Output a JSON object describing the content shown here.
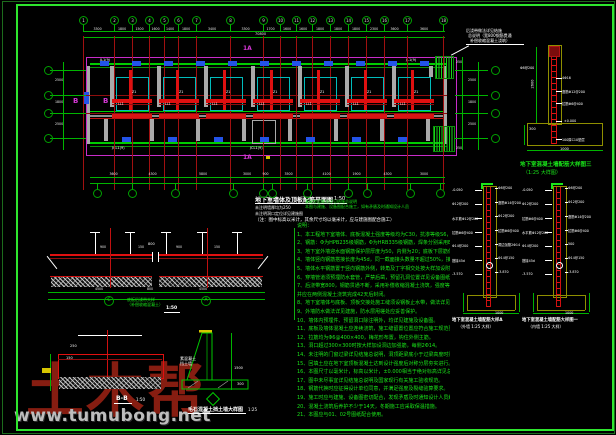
{
  "watermark": {
    "brand": "土木帮",
    "site": "www.tumubong.net"
  },
  "plan": {
    "grid_x": [
      83,
      114,
      132,
      149,
      164,
      178,
      196,
      230,
      263,
      280,
      296,
      312,
      330,
      348,
      366,
      384,
      407,
      443
    ],
    "grid_labels": [
      "1",
      "2",
      "3",
      "4",
      "5",
      "6",
      "7",
      "8",
      "9",
      "10",
      "11",
      "12",
      "13",
      "14",
      "15",
      "16",
      "17",
      "18"
    ],
    "top_dims": [
      "3300",
      "1800",
      "1500",
      "1600",
      "1400",
      "1800",
      "3400",
      "3300",
      "1700",
      "1600",
      "1600",
      "1800",
      "1800",
      "1800",
      "2300",
      "3600",
      "3600"
    ],
    "total_dim": "70800",
    "bottom_grid_x": [
      97,
      132,
      175,
      233,
      263,
      272,
      307,
      348,
      367,
      410,
      440
    ],
    "bottom_dims": [
      "3600",
      "4300",
      "5800",
      "3000",
      "900",
      "3500",
      "4100",
      "1900",
      "4300",
      "3000"
    ],
    "row_y": [
      70,
      95,
      113,
      138
    ],
    "left_dims": [
      "2500",
      "1800",
      "2500"
    ],
    "right_dims_col": [
      "2500",
      "1800",
      "2500"
    ],
    "bay_x": [
      116,
      163,
      210,
      257,
      304,
      351,
      398
    ],
    "bay_tag_beam": "LL1",
    "bay_tag_col": "Z1",
    "clips_top_x": [
      100,
      132,
      164,
      196,
      228,
      260,
      292,
      324,
      356,
      388,
      420
    ],
    "clips_bot_x": [
      122,
      168,
      214,
      260,
      306,
      352,
      398
    ],
    "stubs_low_x": [
      104,
      150,
      196,
      242,
      288,
      334,
      380,
      426
    ],
    "section_marks": {
      "top": "1A",
      "bottom": "1A",
      "b1": "B",
      "b2": "B"
    },
    "beam_labels": {
      "tl": "JL1(9)",
      "tr": "JL1(9)",
      "bl": "JCL1(9)",
      "br": "JCL1(9)"
    },
    "right_end_dims": [
      "250",
      "250"
    ],
    "leader_note": [
      "后浇带做法详见结施",
      "总说明（宽800钢筋贯通",
      "补偿收缩混凝土浇筑）"
    ],
    "title": {
      "main": "地下室墙体及顶板配筋平面图",
      "scale": "1:50",
      "note1": "未注明墙厚均为250",
      "note2": "未注明洞口定位详见建施图",
      "extra": "（注：图中标高以米计，其余尺寸均以毫米计，应与建施图配合施工）"
    },
    "green_notes": [
      "基础垫层做法详见结施总说明",
      "本图与建施、设备图配合施工，如有矛盾及时通知设计人员"
    ]
  },
  "notes": {
    "lines": [
      "说明：",
      "1、本工程地下室墙体、底板混凝土强度等级均为C30，抗渗等级S6，垫层为C10素混凝土。",
      "2、钢筋：Φ为HPB235级钢筋，Φ为HRB335级钢筋，焊条分别采用E43、E50型。",
      "3、地下室外墙迎水面钢筋保护层厚度为50，内侧为20；底板下层筋保护层为40。",
      "4、墙体竖向钢筋搭接长度为45d，同一截面接头数量不超过50%，接头相互错开500。",
      "5、墙体水平钢筋置于竖向钢筋外侧，转角及丁字相交处按大样加设附加筋。",
      "6、穿墙管道须预埋防水套管，严禁后凿，预留孔洞位置详见设备图纸。",
      "7、后浇带宽800，钢筋贯通不断，采用补偿收缩混凝土浇筑，强度等级提高一级，",
      "    并应在两侧混凝土浇筑完成42天后封闭。",
      "8、地下室墙体与底板、顶板交接处施工缝须设钢板止水带，做法详见大样图。",
      "9、外墙防水做法详见建施，防水层甩槎处应妥善保护。",
      "10、墙体内预埋件、预留洞口除注明外，均详见建施及设备图。",
      "11、底板及墙体混凝土应连续浇筑，施工缝留置位置应符合施工规范要求。",
      "12、拉筋均为Φ6@400×400，梅花形布置，钩住外侧主筋。",
      "13、洞口超过300×300时按大样加设洞边加强筋，每侧2Φ14。",
      "14、未注明的门窗过梁详见结施总说明，洞顶距梁底小于过梁高度时梁下挂板。",
      "15、回填土应在地下室顶板混凝土达到设计强度后对称分层夯实进行。",
      "16、本图尺寸以毫米计，标高以米计，±0.000相当于绝对标高详见总平面图。",
      "17、图中未尽事宜详见结施总说明及国家现行有关施工验收规范。",
      "18、钢筋代换时应征得设计单位同意，并满足强度及裂缝验算要求。",
      "19、施工时应与建施、设备图密切配合，发现矛盾及时通知设计人员解决。",
      "20、混凝土浇筑后养护不少于14天，冬期施工应采取保温措施。",
      "21、本图应与01、02号图纸配合使用。"
    ]
  },
  "details": {
    "wall3": {
      "title": "地下室混凝土墙配筋大样图三",
      "subtitle": "（1:25 大样图）",
      "labels_left": [
        "Φ8@200"
      ],
      "labels_right": [
        "4Φ16",
        "竖筋Φ12@200",
        "拉筋Φ6@400",
        "±0.000",
        "100厚C10垫层"
      ],
      "dim_h": "2600",
      "dim_w": "1000",
      "dim_step": "300"
    },
    "wallA": {
      "title": "地下室混凝土墙配筋大样A",
      "subtitle": "（外墙 1:25 大样）",
      "labels_left": [
        "-0.050",
        "Φ12@200",
        "水平筋Φ12@200",
        "拉筋Φ6@400",
        "Φ14@200",
        "搭接45d",
        "-3.570"
      ],
      "labels_right": [
        "Φ8@200",
        "竖筋Φ14@200",
        "Φ12@200",
        "拉筋Φ6@400",
        "洞边加筋2Φ14",
        "Φ14@150",
        "-3.870"
      ],
      "dim_w": "1000"
    },
    "wall1": {
      "title": "地下室混凝土墙配筋大样图一",
      "subtitle": "（内墙 1:25 大样）",
      "labels_left": [
        "-0.050",
        "Φ12@200",
        "拉筋Φ6@400",
        "水平筋Φ12@200",
        "Φ14@200",
        "搭接45d",
        "-3.570"
      ],
      "labels_right": [
        "Φ8@200",
        "Φ12@200",
        "竖筋Φ14@200",
        "拉筋Φ6@400",
        "500",
        "Φ14@150",
        "-3.870"
      ],
      "dim_w": "1000"
    },
    "raft": {
      "label1": "底板后浇带大样",
      "label2": "（补偿收缩混凝土）",
      "scale": "1:50",
      "bubbles": [
        "C",
        "A"
      ],
      "dims_top": [
        "900",
        "150",
        "900",
        "150"
      ],
      "dims_bottom": [
        "4500",
        "800",
        "4500"
      ],
      "gap_dim": "800"
    },
    "bb": {
      "name": "B-B",
      "scale": "1:50",
      "dim1": "150",
      "dim2": "250"
    },
    "retain": {
      "title": "毛石混凝土挡土墙大样图",
      "scale": "1:25",
      "label1": "素混凝土",
      "label2": "挡土墙",
      "dim_h": "1500",
      "dim_w": "300"
    }
  }
}
